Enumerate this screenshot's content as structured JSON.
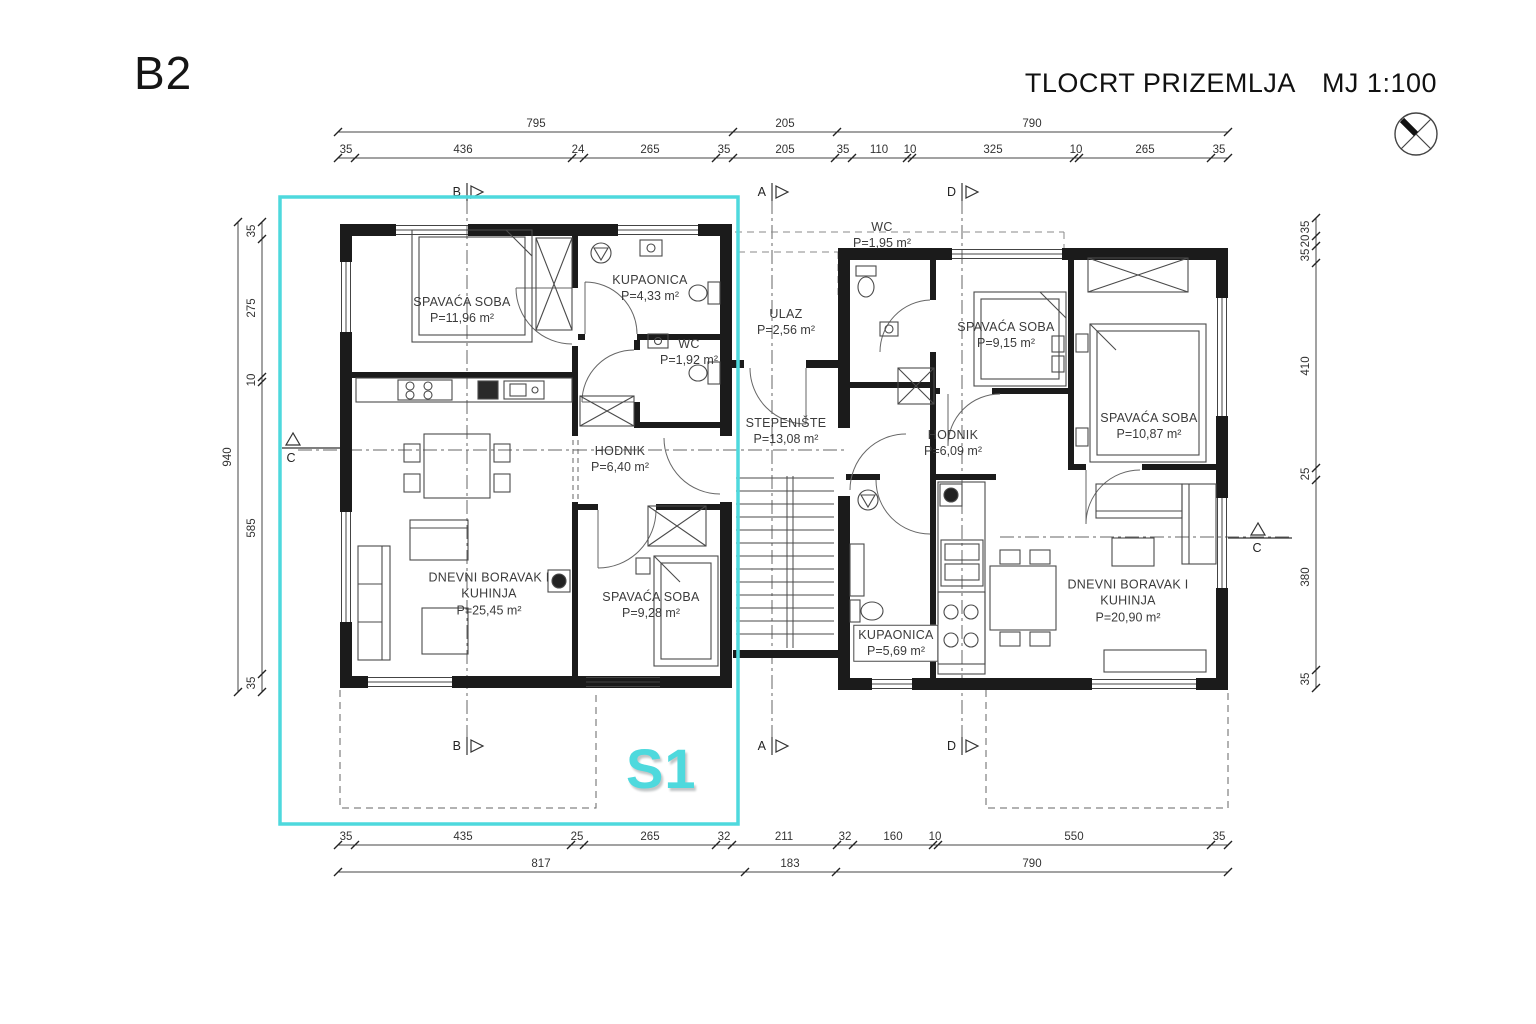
{
  "page": {
    "plan_code": "B2",
    "title": "TLOCRT PRIZEMLJA",
    "scale": "MJ 1:100",
    "unit_label": "S1"
  },
  "colors": {
    "highlight_cyan": "#4ED9DD",
    "walls": "#1b1b1b",
    "dimension_text": "#333333"
  },
  "dims": {
    "top_outer": [
      "795",
      "205",
      "790"
    ],
    "top_inner": [
      "35",
      "436",
      "24",
      "265",
      "35",
      "205",
      "35",
      "110",
      "10",
      "325",
      "10",
      "265",
      "35"
    ],
    "left_outer": [
      "940"
    ],
    "left_inner": [
      "35",
      "275",
      "10",
      "585",
      "35"
    ],
    "right_inner": [
      "35",
      "20",
      "35",
      "410",
      "25",
      "380",
      "35"
    ],
    "bottom_inner": [
      "35",
      "435",
      "25",
      "265",
      "32",
      "211",
      "32",
      "160",
      "10",
      "550",
      "35"
    ],
    "bottom_outer": [
      "817",
      "183",
      "790"
    ]
  },
  "markers": {
    "top": [
      "B",
      "A",
      "D"
    ],
    "bottom": [
      "B",
      "A",
      "D"
    ],
    "left": "C",
    "right": "C"
  },
  "rooms": {
    "s1": [
      {
        "name": "SPAVAĆA SOBA",
        "area": "P=11,96 m²"
      },
      {
        "name": "KUPAONICA",
        "area": "P=4,33 m²"
      },
      {
        "name": "WC",
        "area": "P=1,92 m²"
      },
      {
        "name": "HODNIK",
        "area": "P=6,40 m²"
      },
      {
        "name": "DNEVNI BORAVAK I KUHINJA",
        "area": "P=25,45 m²"
      },
      {
        "name": "SPAVAĆA SOBA",
        "area": "P=9,28 m²"
      }
    ],
    "common": [
      {
        "name": "ULAZ",
        "area": "P=2,56 m²"
      },
      {
        "name": "STEPENIŠTE",
        "area": "P=13,08 m²"
      }
    ],
    "s2": [
      {
        "name": "WC",
        "area": "P=1,95 m²"
      },
      {
        "name": "SPAVAĆA SOBA",
        "area": "P=9,15 m²"
      },
      {
        "name": "SPAVAĆA SOBA",
        "area": "P=10,87 m²"
      },
      {
        "name": "HODNIK",
        "area": "P=6,09 m²"
      },
      {
        "name": "KUPAONICA",
        "area": "P=5,69 m²"
      },
      {
        "name": "DNEVNI BORAVAK I KUHINJA",
        "area": "P=20,90 m²"
      }
    ]
  }
}
